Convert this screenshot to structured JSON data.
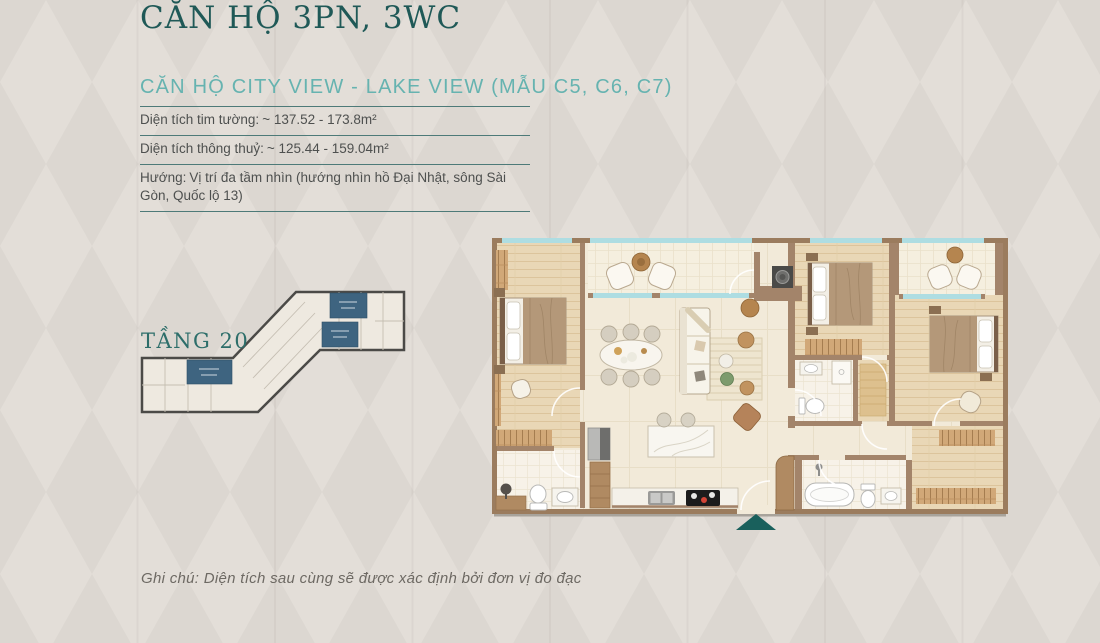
{
  "header": {
    "title": "CĂN HỘ 3PN, 3WC",
    "subtitle": "CĂN HỘ CITY VIEW - LAKE VIEW (MẪU C5, C6, C7)"
  },
  "specs": [
    {
      "label": "Diện tích tim tường:",
      "value": "~ 137.52 - 173.8m²"
    },
    {
      "label": "Diện tích thông thuỷ:",
      "value": "~ 125.44 - 159.04m²"
    },
    {
      "label": "Hướng:",
      "value": "Vị trí đa tầm nhìn (hướng nhìn hồ Đại Nhật, sông Sài Gòn, Quốc lộ 13)"
    }
  ],
  "key_plan": {
    "floor_label": "TẦNG 20",
    "highlighted_units": 3,
    "highlight_color": "#3e6480"
  },
  "floor_plan": {
    "entrance_marker_color": "#19605c"
  },
  "note": {
    "text": "Ghi chú: Diện tích sau cùng sẽ được xác định bởi đơn vị đo đạc"
  },
  "colors": {
    "background": "#dcd7d1",
    "diamond": "#e3ded8",
    "title": "#1f5957",
    "subtitle": "#66b3b0",
    "separator": "#4d7a78",
    "body_text": "#4e504f",
    "floor_label": "#2d6e6a",
    "plan_wall": "#a3846a",
    "plan_window": "#aedde2"
  }
}
